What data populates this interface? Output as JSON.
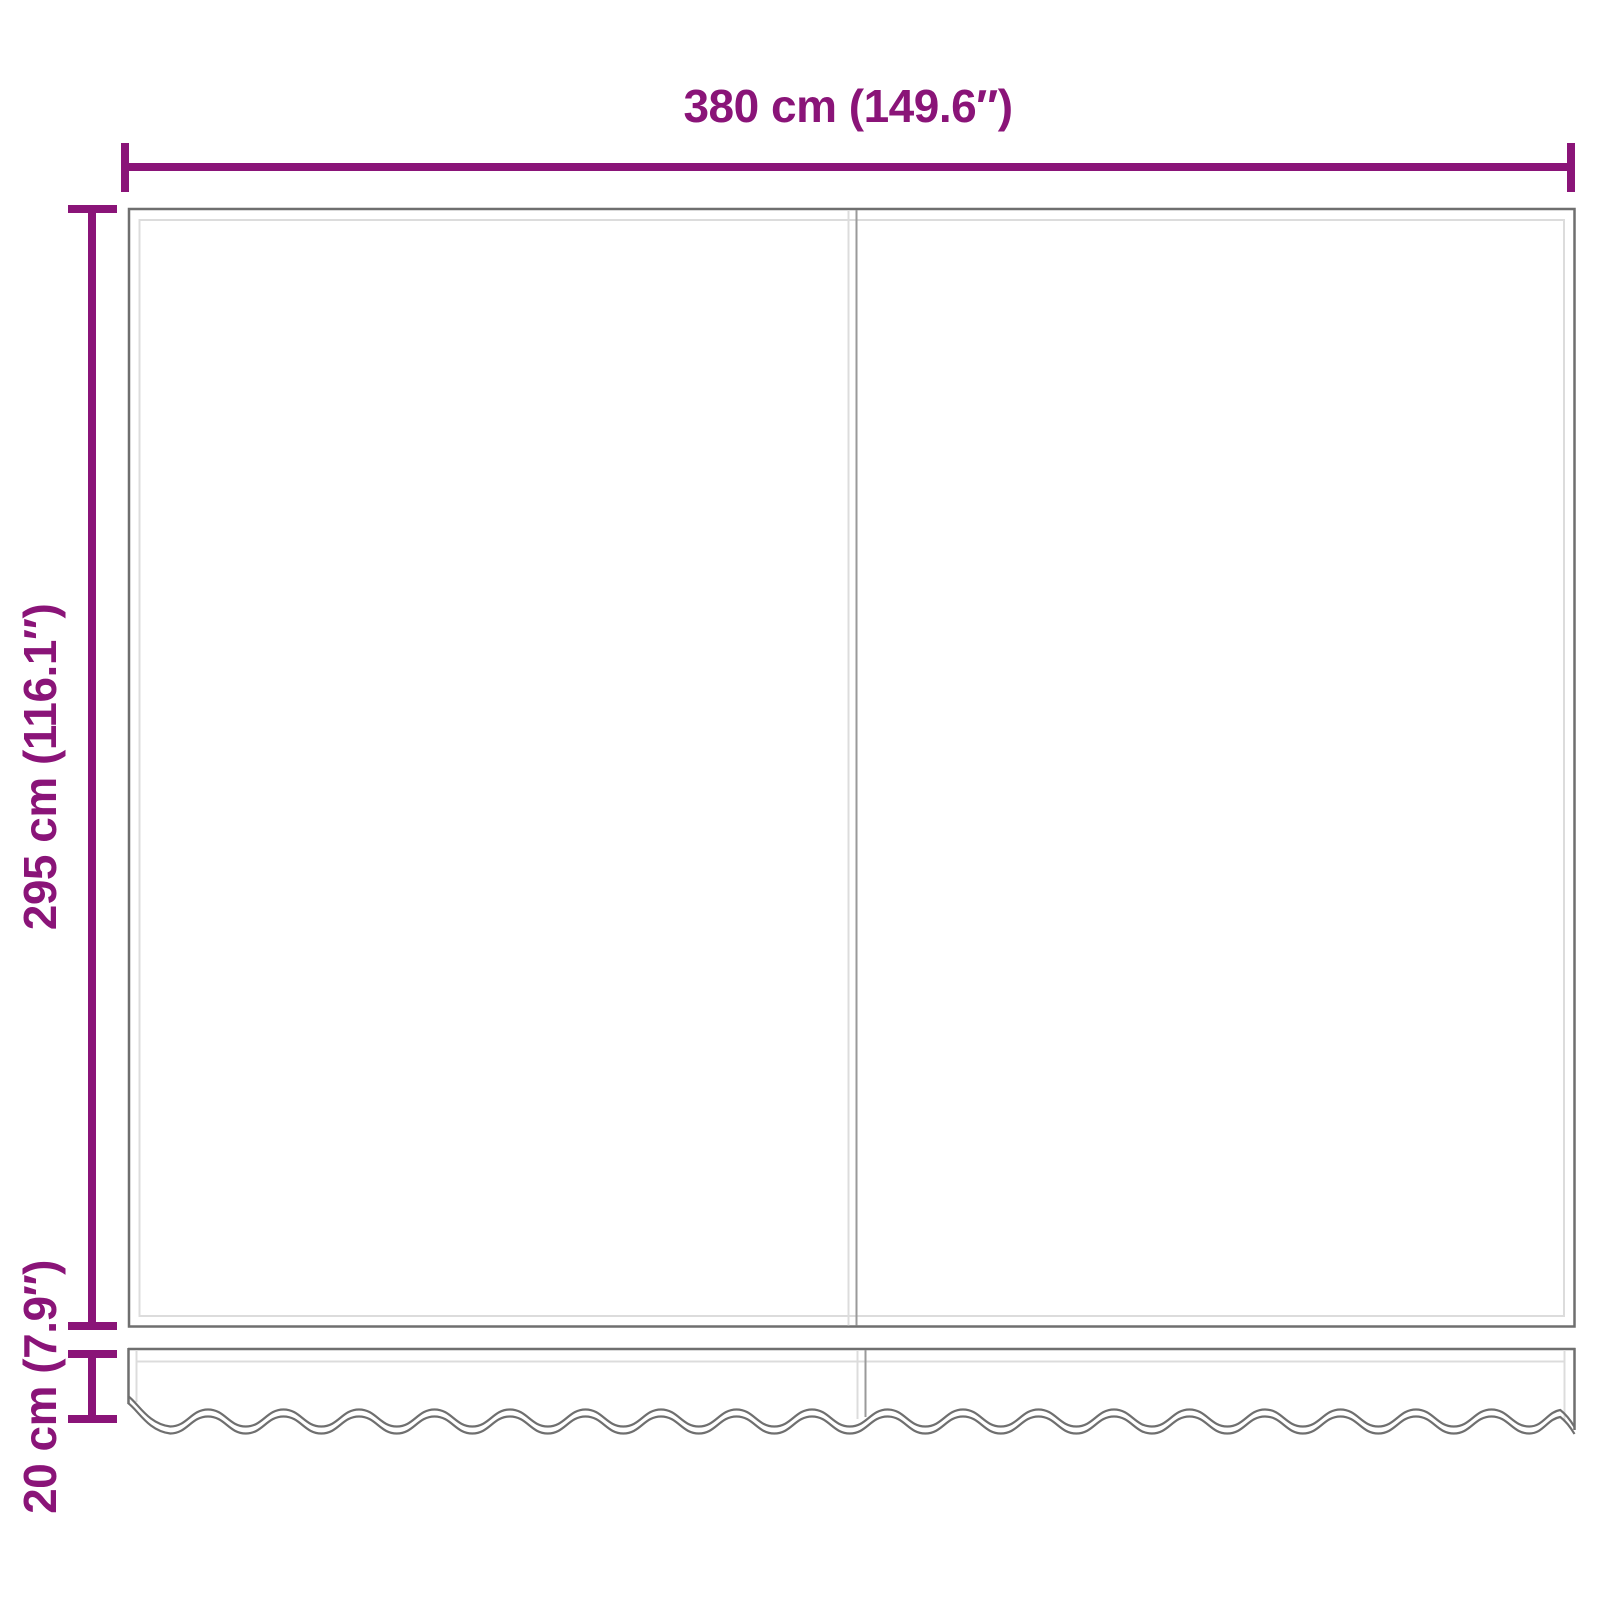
{
  "page": {
    "background_color": "#FFFFFF",
    "description": "Dimension diagram of replacement awning fabric with scalloped valance"
  },
  "diagram": {
    "accent_color": "#8A1478",
    "outline_color": "#6F6F6F",
    "seam_color": "#9A9A9A",
    "inner_line_color": "#DCDCDC",
    "annotations": {
      "width_label": "380 cm (149.6″)",
      "height_label": "295 cm (116.1″)",
      "valance_height_label": "20 cm (7.9″)"
    }
  }
}
